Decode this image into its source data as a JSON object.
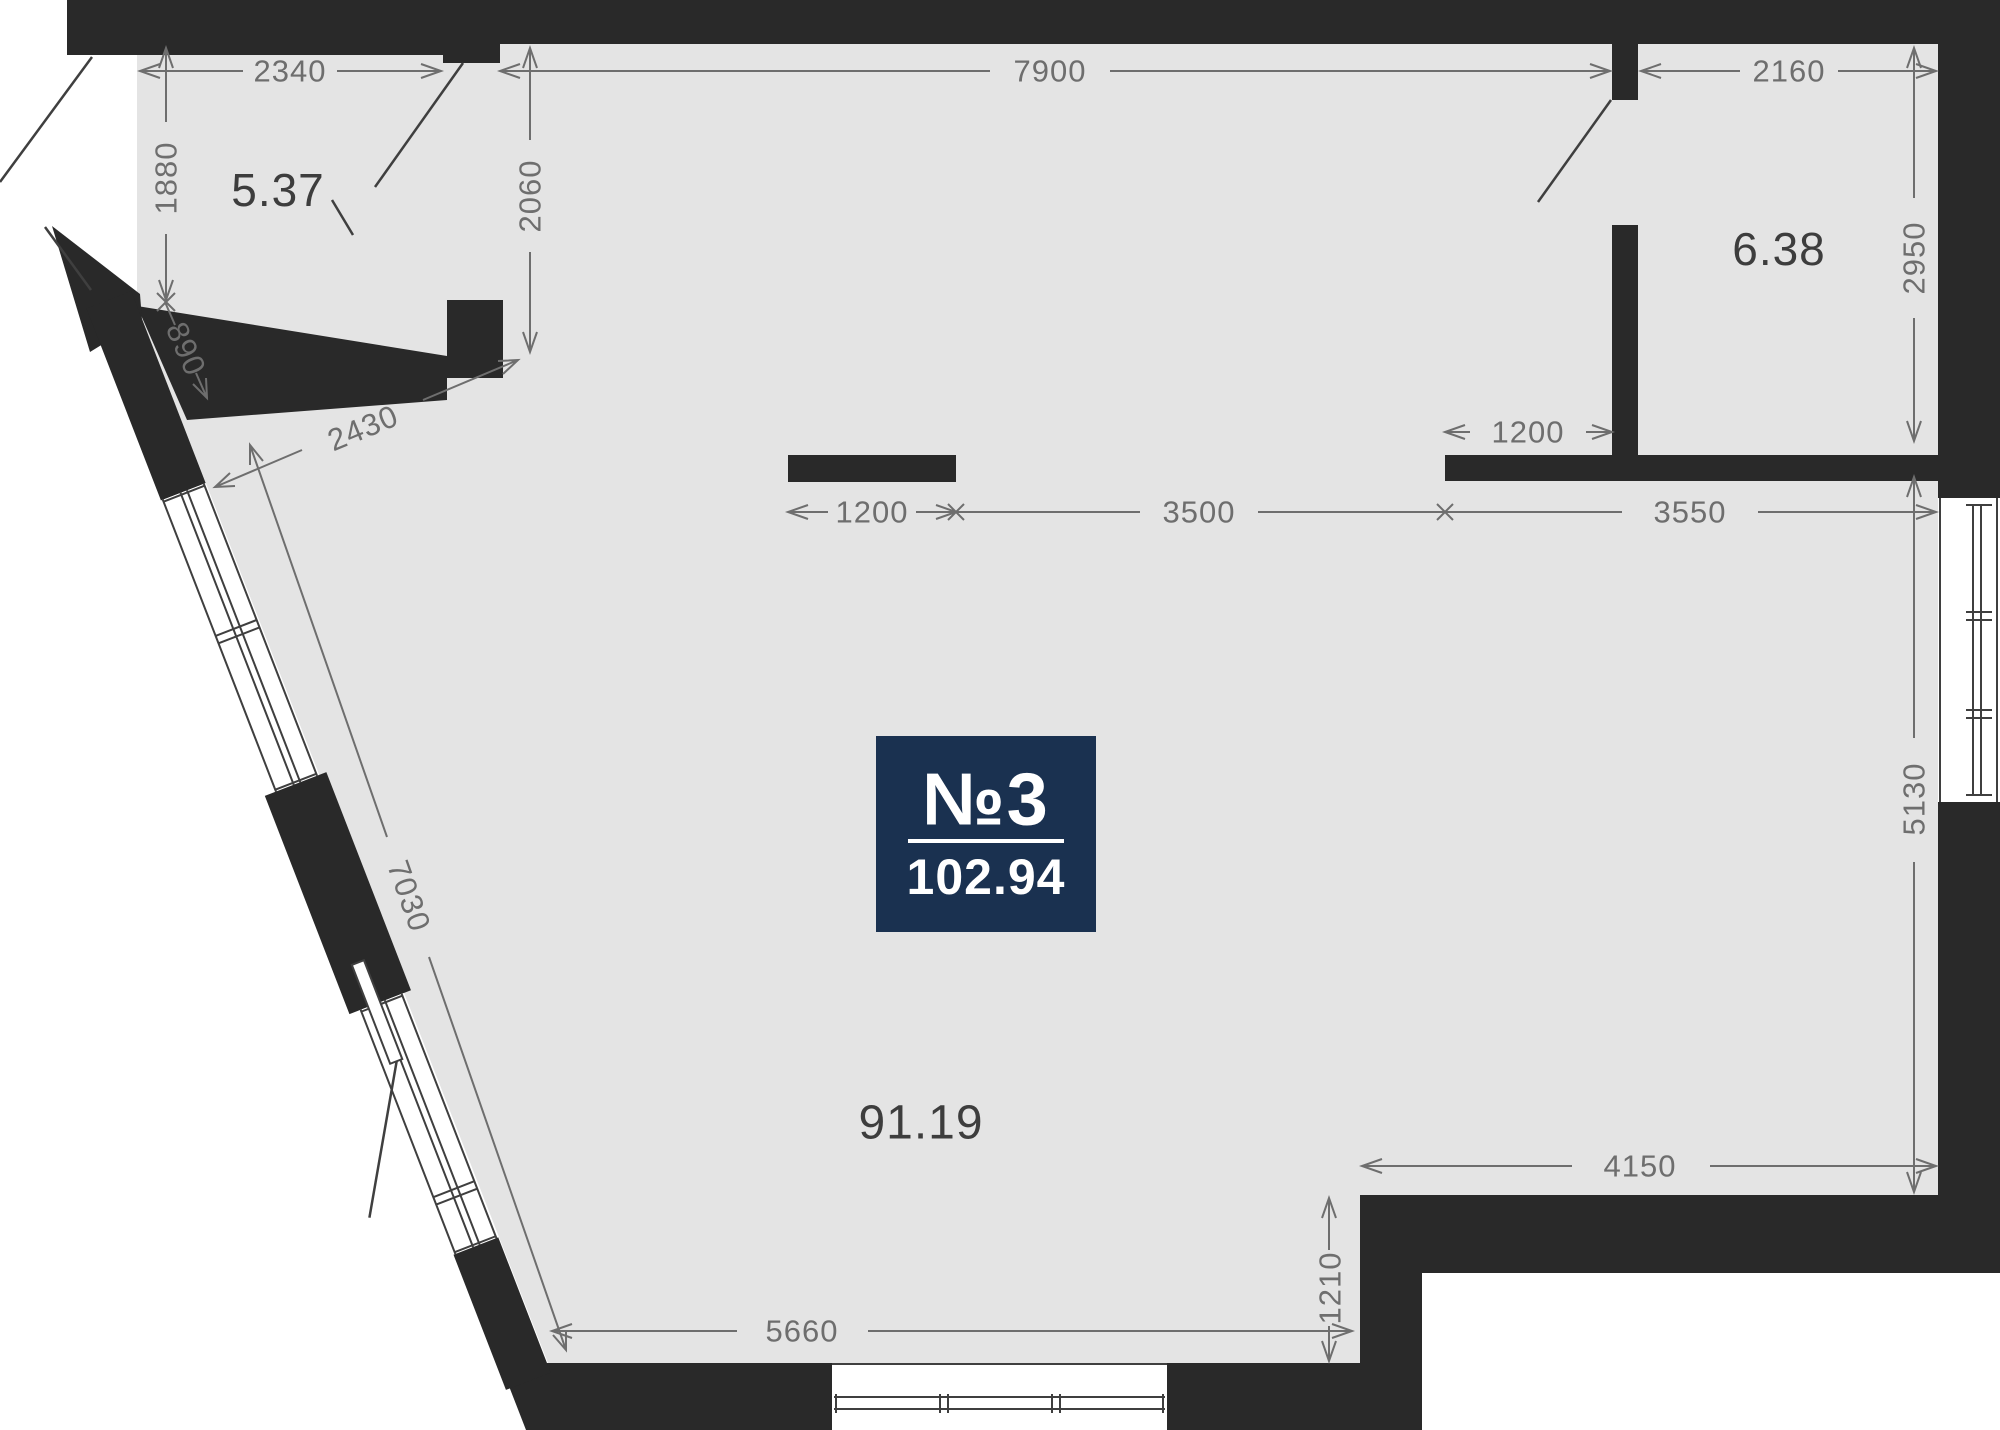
{
  "plan": {
    "badge": {
      "unit_label": "№3",
      "total_area": "102.94"
    },
    "areas": {
      "room_top_left": "5.37",
      "room_top_right": "6.38",
      "room_main": "91.19"
    },
    "dimensions": {
      "top_left": "2340",
      "top_middle": "7900",
      "top_right": "2160",
      "left_vertical": "1880",
      "left_doorway_diag": "890",
      "left_wall_diag": "2430",
      "left_long_diag": "7030",
      "inner_left_vertical": "2060",
      "right_upper_vertical": "2950",
      "right_lower_vertical": "5130",
      "mid_stub": "1200",
      "mid_left_span": "3500",
      "mid_right_span": "3550",
      "kitchen_opening": "1200",
      "bottom_right_span": "4150",
      "bottom_step": "1210",
      "bottom_span": "5660"
    },
    "colors": {
      "background": "#ffffff",
      "wall": "#292929",
      "floor": "#e4e4e4",
      "dim": "#6e6e6e",
      "area_label": "#3d3d3d",
      "frame": "#3f3f3f",
      "badge_bg": "#1a3150",
      "badge_text": "#ffffff"
    }
  }
}
